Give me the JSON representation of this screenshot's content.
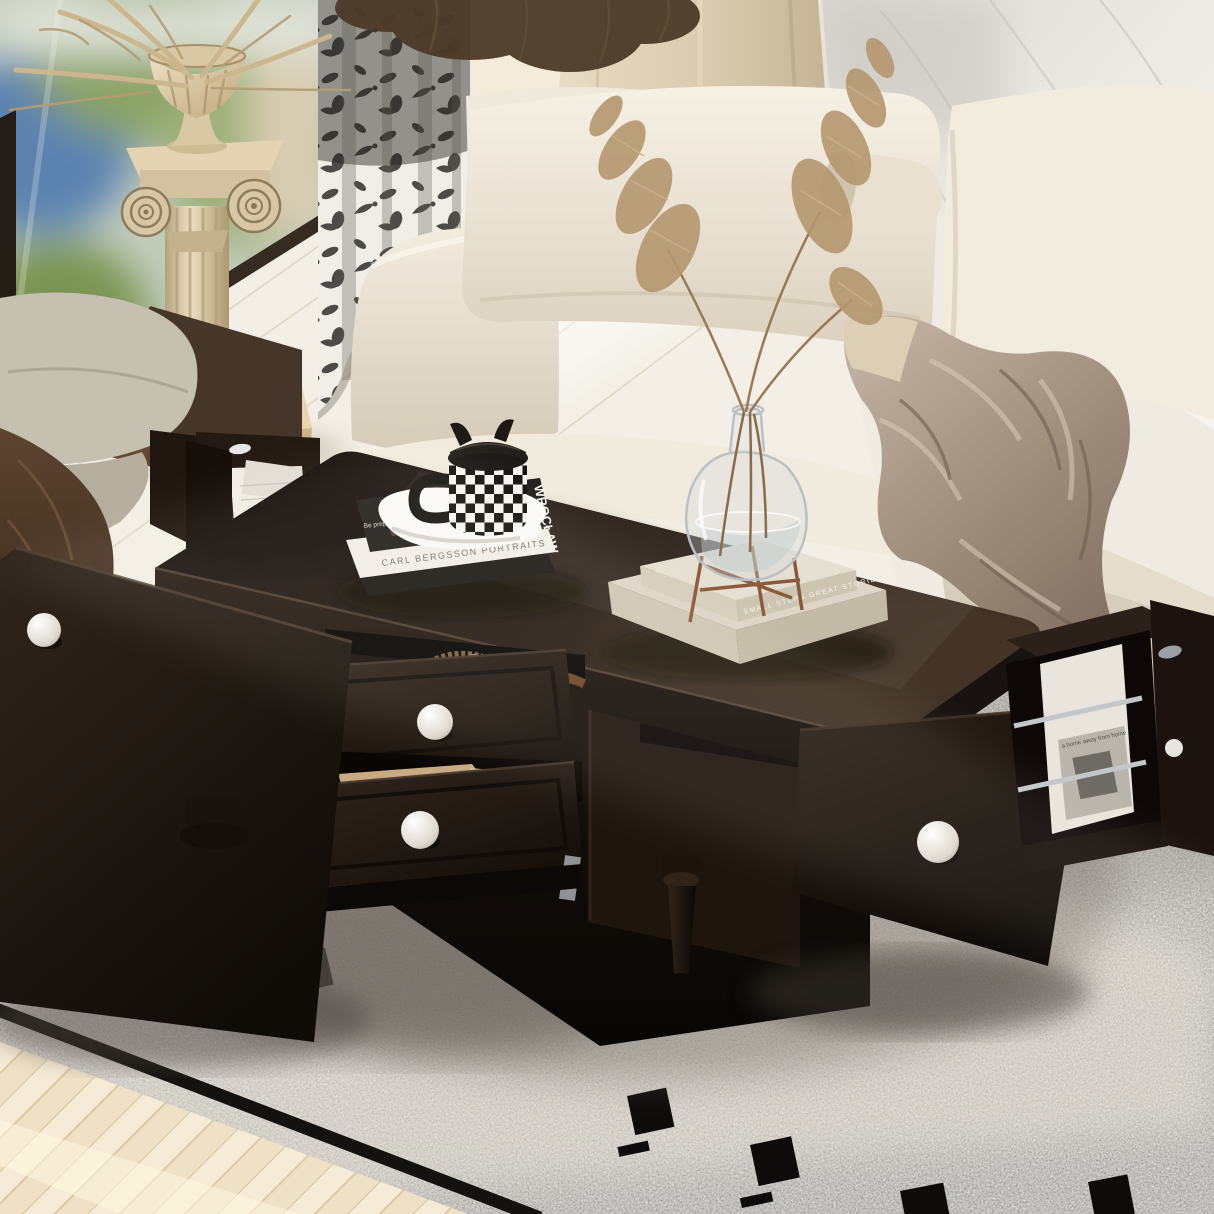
{
  "scene": {
    "description": "Product photo: espresso-brown coffee table with two open storage drawers, open front doors and end magazine racks, styled in a cream living room",
    "room": {
      "wall": "white marble with soft veining",
      "window_view": "blurred greenery and city light",
      "floor": "pale oak planks with herringbone section",
      "rug": "speckled ivory rug with black squares and dashes border motif"
    }
  },
  "palette": {
    "table": "#261c15",
    "table_highlight": "#3d2f24",
    "knob": "#f2efe9",
    "sofa": "#f1ebde",
    "sofa_shadow": "#d8cebd",
    "rug": "#d7d2ca",
    "blanket": "#a6968a",
    "curtain_ink": "#1b1a18",
    "column": "#d9c9a8",
    "armchair": "#c6c0b1",
    "armchair_throw": "#4b3727",
    "floor": "#f3efe6",
    "marble": "#eae8e3",
    "rail": "#c4c7ca"
  },
  "coffee_table": {
    "finish": "espresso",
    "drawers": [
      {
        "position": "top",
        "state": "open",
        "contents": "wrist watch and leather belt"
      },
      {
        "position": "bottom",
        "state": "open",
        "contents": "kraft paper envelopes"
      }
    ],
    "doors": [
      {
        "position": "front-left",
        "state": "open wide"
      },
      {
        "position": "front-right",
        "state": "open"
      },
      {
        "position": "right-end",
        "state": "open"
      }
    ],
    "magazine_racks": [
      {
        "position": "left-end",
        "rails": "chrome",
        "contents": "white magazines"
      },
      {
        "position": "right-end",
        "rails": "chrome",
        "contents": "photo magazines"
      }
    ],
    "legs": "turned espresso feet"
  },
  "books": {
    "stack_left": {
      "top_cover_title": "WROCŁAW",
      "top_spine": "Be prepared | Wrocław — welcome to Polish diamond",
      "bottom_spine": "CARL BERGSSON PORTRAITS"
    },
    "stack_right": {
      "top_spine": "SMALL STEPS GREAT STORIES"
    }
  },
  "right_rack_magazine": {
    "cover_line": "a home away from home"
  },
  "decor": {
    "mug": "black and white checkerboard mug with cat-ear lid on sculpted saucer",
    "vase": "clear glass bud vase on copper stand with pampas grass",
    "pedestal": "ionic column pedestal with urn of dried palms",
    "sofa_throw": "taupe satin blanket",
    "armchair_throw": "chocolate fringed throw"
  }
}
